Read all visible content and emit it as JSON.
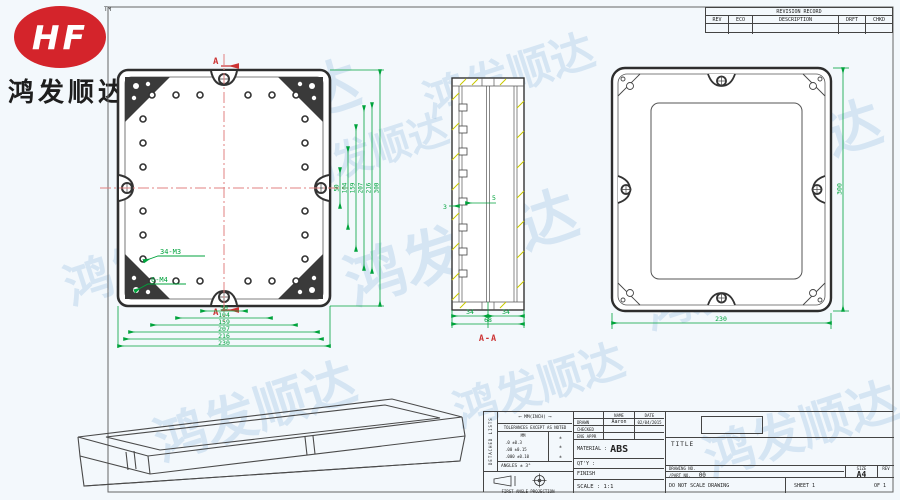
{
  "logo": {
    "monogram": "HF",
    "trademark": "TM",
    "company": "鸿发顺达"
  },
  "watermark": {
    "text": "鸿发顺达"
  },
  "revision_record": {
    "title": "REVISION RECORD",
    "columns": {
      "rev": "REV",
      "eco": "ECO",
      "description": "DESCRIPTION",
      "drft": "DRFT",
      "chkd": "CHKD"
    }
  },
  "front_view": {
    "section_marker_top": "A",
    "section_marker_bottom": "A",
    "callout_m3": "34-M3",
    "callout_m4": "6-M4",
    "dims_bottom": [
      "50",
      "104",
      "159",
      "207",
      "216",
      "230"
    ],
    "dims_right": [
      "50",
      "104",
      "159",
      "207",
      "216",
      "300"
    ]
  },
  "section_view": {
    "label": "A-A",
    "dim_rib": "5",
    "dim_wall": "3",
    "dim_half_left": "34",
    "dim_half_right": "34",
    "dim_total": "68"
  },
  "back_view": {
    "dim_width": "230",
    "dim_height": "300"
  },
  "title_block": {
    "side_note": "DETACHED LISTS",
    "units_header": "MM(INCH)",
    "tolerance_note": "TOLERANCES EXCEPT AS NOTED",
    "tol_unit": "MM",
    "tol_rows": [
      {
        "mm": ".0  ±0.3",
        "inch": "±"
      },
      {
        "mm": ".00 ±0.15",
        "inch": "±"
      },
      {
        "mm": ".000 ±0.10",
        "inch": "±"
      }
    ],
    "angles": "ANGLES ± 3°",
    "projection": "FIRST ANGLE PROJECTION",
    "name_header": "NAME",
    "date_header": "DATE",
    "drawn_label": "DRAWN",
    "drawn_name": "Aaron",
    "drawn_date": "02/04/2015",
    "checked_label": "CHECKED",
    "eng_appr_label": "ENG APPR",
    "material_label": "MATERIAL :",
    "material_value": "ABS",
    "qty_label": "QT'Y :",
    "finish_label": "FINISH",
    "scale_label": "SCALE : 1:1",
    "title_label": "TITLE",
    "drawing_no_label": "DRAWING NO.",
    "part_no_label": "/PART  NO.",
    "part_no_value": "00",
    "size_label": "SIZE",
    "size_value": "A4",
    "rev_label": "REV",
    "do_not_scale": "DO NOT SCALE DRAWING",
    "sheet_text": "SHEET 1",
    "of_text": "OF 1"
  }
}
